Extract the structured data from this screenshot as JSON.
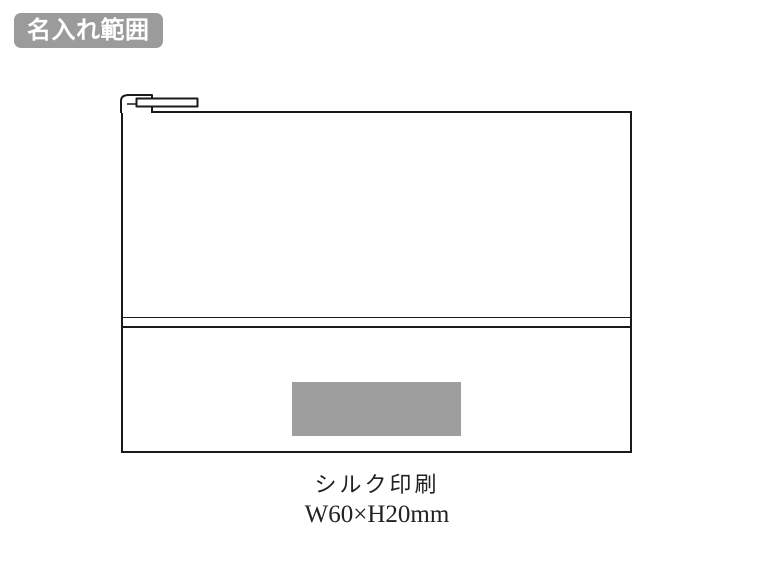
{
  "colors": {
    "page_bg": "#ffffff",
    "line_color": "#1a1a1a",
    "badge_bg": "#9b9b9b",
    "badge_text": "#ffffff",
    "print_fill": "#9e9e9e",
    "caption_color": "#222222"
  },
  "badge": {
    "label": "名入れ範囲"
  },
  "diagram": {
    "product": "flat zipper pouch, front view, line drawing",
    "print_area_note": "gray rectangle marks imprint position on lower front pocket"
  },
  "caption": {
    "print_method": "シルク印刷",
    "print_size": "W60×H20mm"
  }
}
